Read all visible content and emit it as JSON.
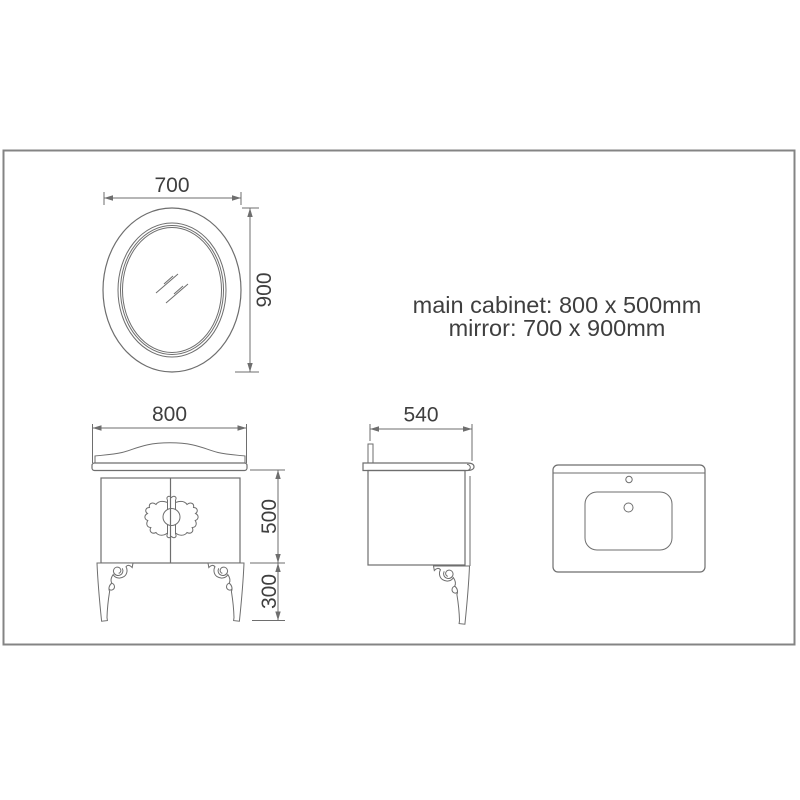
{
  "notes": {
    "line1": "main cabinet: 800 x 500mm",
    "line2": "mirror: 700 x 900mm"
  },
  "mirror_view": {
    "width_dim": "700",
    "height_dim": "900"
  },
  "front_view": {
    "width_dim": "800",
    "body_height_dim": "500",
    "leg_height_dim": "300"
  },
  "side_view": {
    "depth_dim": "540"
  },
  "colors": {
    "background": "#ffffff",
    "line": "#6e6e6e",
    "text": "#3f3f3f",
    "frame_border": "#848484"
  }
}
